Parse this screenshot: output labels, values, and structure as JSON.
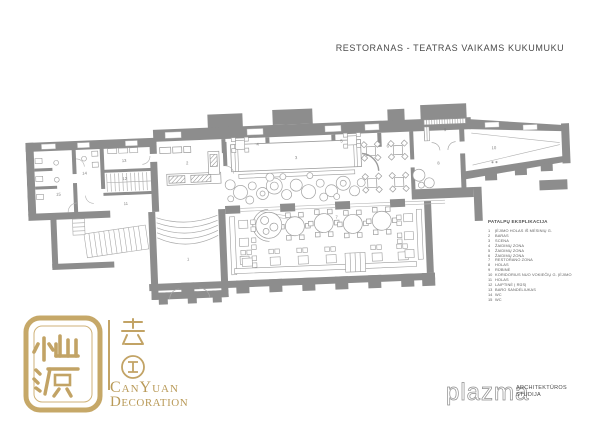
{
  "title": "RESTORANAS - TEATRAS VAIKAMS KUKUMUKU",
  "legend": {
    "heading": "PATALPŲ EKSPLIKACIJA",
    "items": [
      {
        "num": "1",
        "label": "ĮĖJIMO HOLAS IŠ MĖSINIŲ G."
      },
      {
        "num": "2",
        "label": "BARAS"
      },
      {
        "num": "3",
        "label": "SCENA"
      },
      {
        "num": "4",
        "label": "ŽAIDIMŲ ZONA"
      },
      {
        "num": "5",
        "label": "ŽAIDIMŲ ZONA"
      },
      {
        "num": "6",
        "label": "ŽAIDIMŲ ZONA"
      },
      {
        "num": "7",
        "label": "RESTORANO ZONA"
      },
      {
        "num": "8",
        "label": "HOLAS"
      },
      {
        "num": "9",
        "label": "RŪBINĖ"
      },
      {
        "num": "10",
        "label": "KORIDORIUS NUO VOKIEČIŲ G. ĮĖJIMO"
      },
      {
        "num": "11",
        "label": "HOLAS"
      },
      {
        "num": "12",
        "label": "LAIPTINĖ Į RŪSĮ"
      },
      {
        "num": "13",
        "label": "BARO SANDĖLIUKAS"
      },
      {
        "num": "14",
        "label": "WC"
      },
      {
        "num": "15",
        "label": "WC"
      }
    ]
  },
  "plan": {
    "room_markers": [
      "1",
      "2",
      "3",
      "4",
      "5",
      "6",
      "7",
      "8",
      "9",
      "10",
      "11",
      "12",
      "13",
      "14",
      "15"
    ]
  },
  "logos": {
    "canyuan": {
      "line1": "CanYuan",
      "line2": "Decoration",
      "seal_chars": "灿源",
      "side_chars": "装饰"
    },
    "plazma": {
      "name": "plazma",
      "sub1": "ARCHITEKTŪROS",
      "sub2": "STUDIJA"
    }
  },
  "colors": {
    "wall": "#8d8d8d",
    "thin_line": "#a8a8a8",
    "gold": "#c2a365",
    "title_text": "#4b4b4b"
  }
}
